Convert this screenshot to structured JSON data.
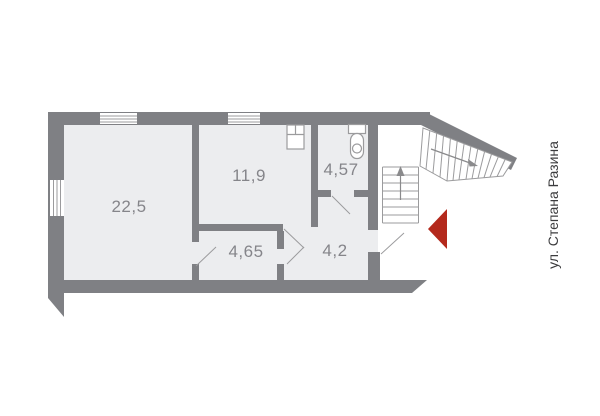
{
  "floor_plan": {
    "street_label": "ул. Степана Разина",
    "rooms": [
      {
        "name": "room-22-5",
        "area": "22,5"
      },
      {
        "name": "room-11-9",
        "area": "11,9"
      },
      {
        "name": "room-4-57",
        "area": "4,57"
      },
      {
        "name": "room-4-65",
        "area": "4,65"
      },
      {
        "name": "room-4-2",
        "area": "4,2"
      }
    ],
    "icons": {
      "entrance_arrow": "red triangle pointing left marking building entrance",
      "stairs_up_arrow": "arrow pointing up along interior stair flight",
      "exterior_stairs_arrow": "arrow pointing down-right along exterior stair flight",
      "toilet": "toilet fixture in room 4,57",
      "sink": "wash basin fixture in room 11,9",
      "windows": "3 window openings: 2 in top wall, 1 in left wall"
    },
    "colors": {
      "wall": "#7f8084",
      "room_fill": "#ecedef",
      "thin_line": "#9b9b9d",
      "room_label": "#85858a",
      "street_label": "#3c3c3e",
      "entrance_arrow": "#b4291c",
      "background": "#ffffff"
    }
  }
}
